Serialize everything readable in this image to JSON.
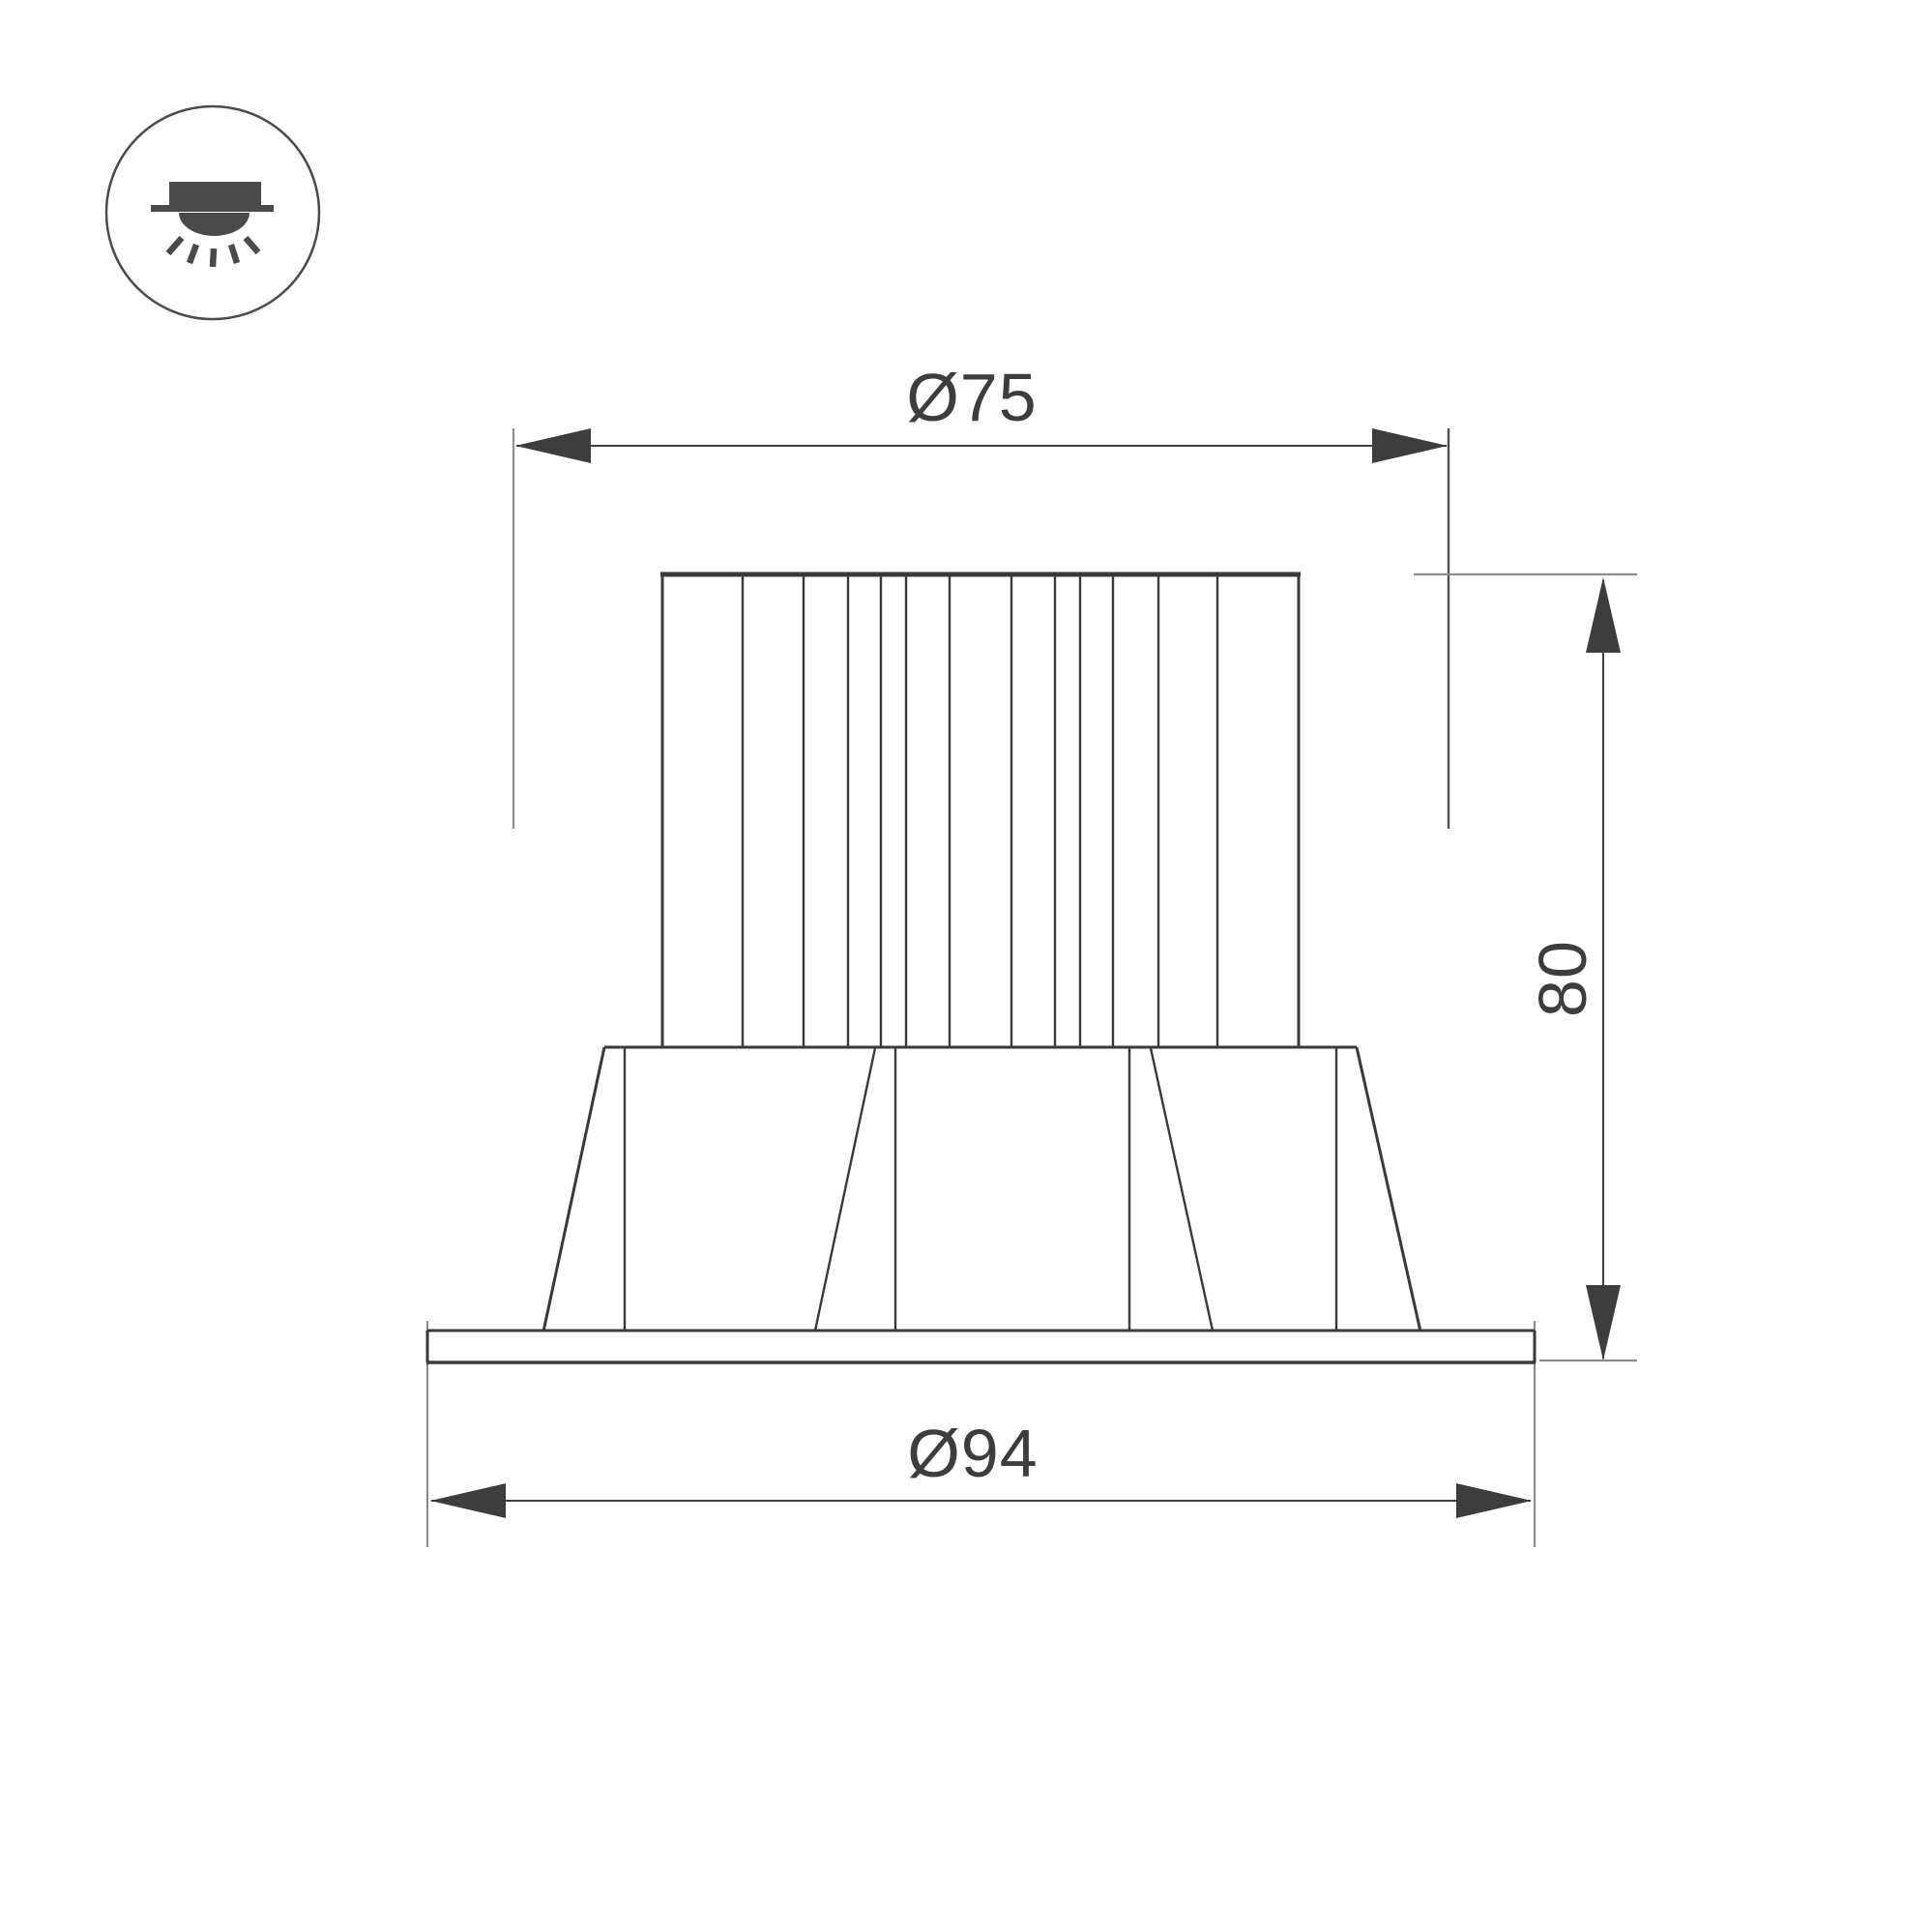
{
  "meta": {
    "drawing_type": "technical dimension drawing",
    "subject": "recessed LED downlight, front elevation",
    "background_color": "#ffffff",
    "outline_color": "#3a3a3a",
    "extension_line_color": "#8c8c8c",
    "text_color": "#3d3d3d",
    "arrow_color": "#3d3d3d"
  },
  "icon": {
    "name": "recessed-downlight",
    "description": "circled pictogram of a recessed ceiling luminaire shining downward"
  },
  "dimensions": {
    "top_diameter": {
      "label": "Ø75",
      "value": 75,
      "kind": "diameter",
      "position": "top"
    },
    "height": {
      "label": "80",
      "value": 80,
      "kind": "linear-vertical",
      "position": "right"
    },
    "bottom_diameter": {
      "label": "Ø94",
      "value": 94,
      "kind": "diameter",
      "position": "bottom"
    }
  }
}
